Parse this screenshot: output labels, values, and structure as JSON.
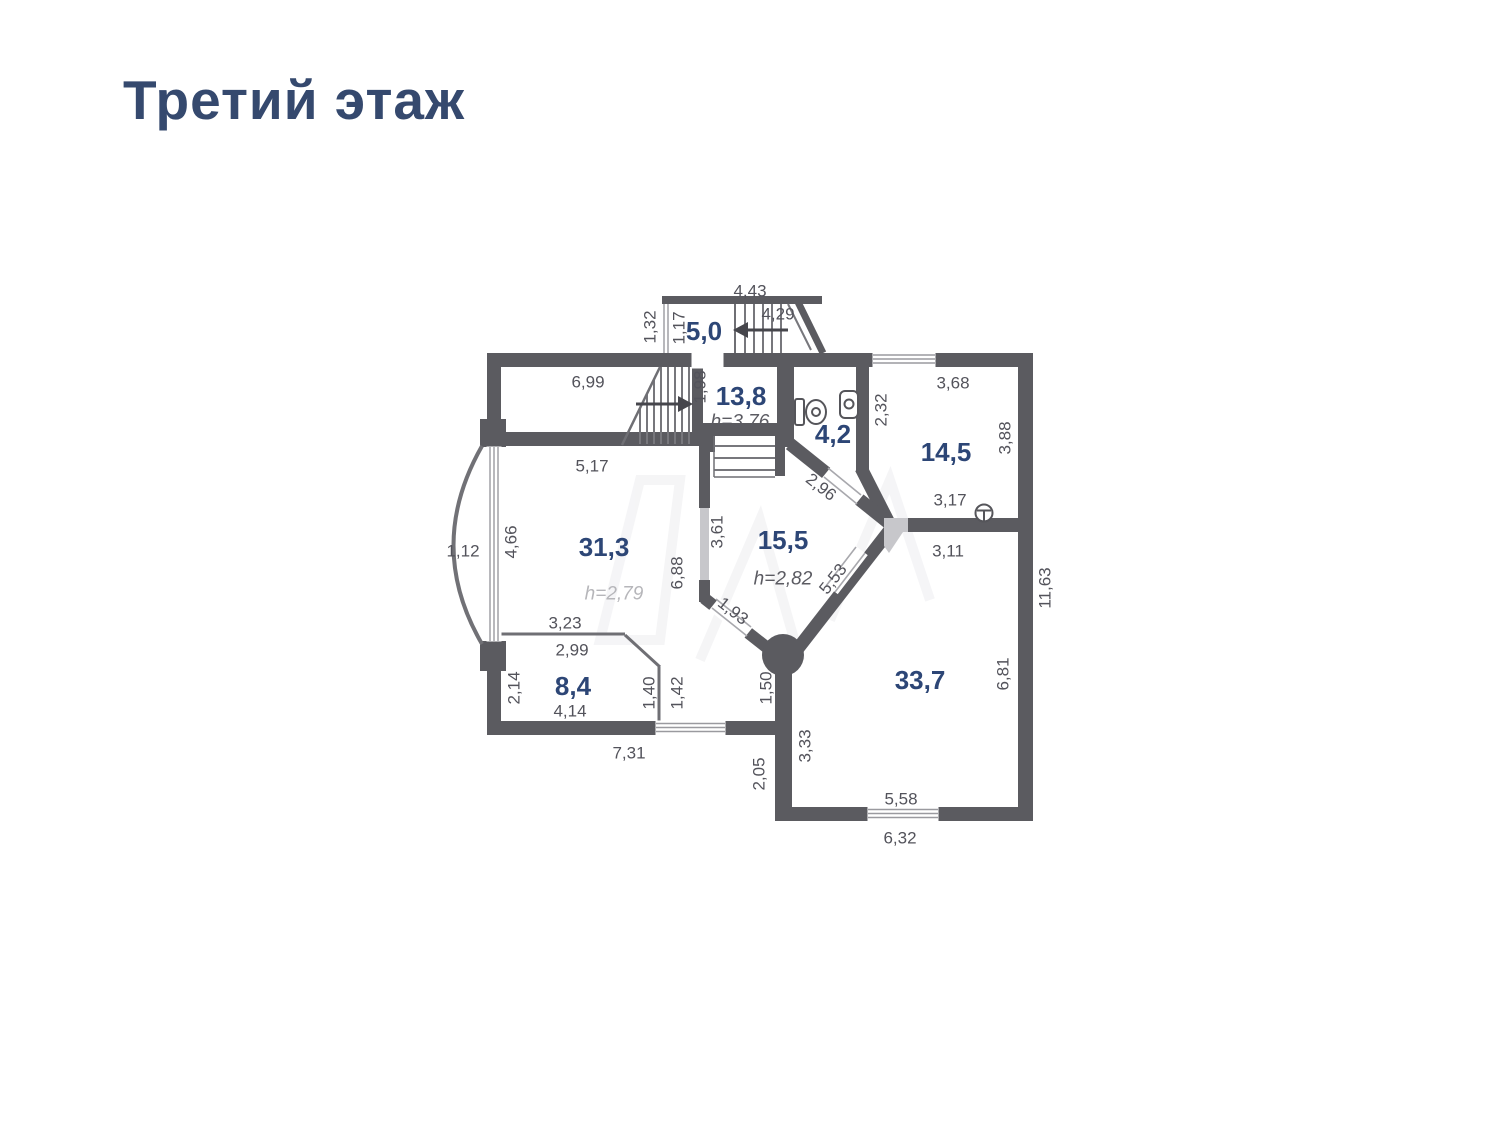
{
  "title": "Третий этаж",
  "plan": {
    "colors": {
      "wall": "#5b5b60",
      "light_wall": "#c7c7cb",
      "area_label": "#2d4676",
      "dim_label": "#53535b",
      "title": "#35496e"
    },
    "rooms": [
      {
        "name": "room-5-0",
        "area": "5,0"
      },
      {
        "name": "room-13-8",
        "area": "13,8",
        "ceiling": "h=3,76"
      },
      {
        "name": "room-4-2",
        "area": "4,2"
      },
      {
        "name": "room-14-5",
        "area": "14,5"
      },
      {
        "name": "room-31-3",
        "area": "31,3",
        "ceiling": "h=2,79"
      },
      {
        "name": "room-15-5",
        "area": "15,5",
        "ceiling": "h=2,82"
      },
      {
        "name": "room-8-4",
        "area": "8,4"
      },
      {
        "name": "room-33-7",
        "area": "33,7"
      }
    ],
    "area_labels": [
      {
        "text": "5,0",
        "x": 704,
        "y": 331
      },
      {
        "text": "13,8",
        "x": 741,
        "y": 396
      },
      {
        "text": "4,2",
        "x": 833,
        "y": 434
      },
      {
        "text": "14,5",
        "x": 946,
        "y": 452
      },
      {
        "text": "31,3",
        "x": 604,
        "y": 547
      },
      {
        "text": "15,5",
        "x": 783,
        "y": 540
      },
      {
        "text": "8,4",
        "x": 573,
        "y": 686
      },
      {
        "text": "33,7",
        "x": 920,
        "y": 680
      }
    ],
    "height_labels": [
      {
        "text": "h=3,76",
        "x": 740,
        "y": 422
      },
      {
        "text": "h=2,79",
        "x": 614,
        "y": 594,
        "light": true
      },
      {
        "text": "h=2,82",
        "x": 783,
        "y": 579
      }
    ],
    "dim_labels": [
      {
        "text": "4,43",
        "x": 750,
        "y": 291
      },
      {
        "text": "4,29",
        "x": 778,
        "y": 314
      },
      {
        "text": "1,32",
        "x": 650,
        "y": 327,
        "rot": -90
      },
      {
        "text": "1,17",
        "x": 679,
        "y": 328,
        "rot": -90
      },
      {
        "text": "6,99",
        "x": 588,
        "y": 382
      },
      {
        "text": "1,98",
        "x": 700,
        "y": 387,
        "rot": -90
      },
      {
        "text": "3,68",
        "x": 953,
        "y": 383
      },
      {
        "text": "2,32",
        "x": 881,
        "y": 410,
        "rot": -90
      },
      {
        "text": "3,88",
        "x": 1005,
        "y": 438,
        "rot": -90
      },
      {
        "text": "5,17",
        "x": 592,
        "y": 466
      },
      {
        "text": "2,96",
        "x": 821,
        "y": 487,
        "rot": 38
      },
      {
        "text": "3,17",
        "x": 950,
        "y": 500
      },
      {
        "text": "3,11",
        "x": 948,
        "y": 551
      },
      {
        "text": "4,66",
        "x": 511,
        "y": 542,
        "rot": -90
      },
      {
        "text": "1,12",
        "x": 463,
        "y": 551
      },
      {
        "text": "3,61",
        "x": 717,
        "y": 532,
        "rot": -90
      },
      {
        "text": "6,88",
        "x": 677,
        "y": 573,
        "rot": -90
      },
      {
        "text": "5,53",
        "x": 833,
        "y": 579,
        "rot": -52
      },
      {
        "text": "1,93",
        "x": 733,
        "y": 611,
        "rot": 38
      },
      {
        "text": "11,63",
        "x": 1045,
        "y": 588,
        "rot": -90
      },
      {
        "text": "3,23",
        "x": 565,
        "y": 623
      },
      {
        "text": "2,99",
        "x": 572,
        "y": 650
      },
      {
        "text": "2,14",
        "x": 514,
        "y": 688,
        "rot": -90
      },
      {
        "text": "1,40",
        "x": 649,
        "y": 693,
        "rot": -90
      },
      {
        "text": "1,42",
        "x": 677,
        "y": 693,
        "rot": -90
      },
      {
        "text": "1,50",
        "x": 766,
        "y": 688,
        "rot": -90
      },
      {
        "text": "6,81",
        "x": 1003,
        "y": 674,
        "rot": -90
      },
      {
        "text": "4,14",
        "x": 570,
        "y": 711
      },
      {
        "text": "7,31",
        "x": 629,
        "y": 753
      },
      {
        "text": "3,33",
        "x": 805,
        "y": 746,
        "rot": -90
      },
      {
        "text": "2,05",
        "x": 759,
        "y": 774,
        "rot": -90
      },
      {
        "text": "5,58",
        "x": 901,
        "y": 799
      },
      {
        "text": "6,32",
        "x": 900,
        "y": 838
      }
    ]
  }
}
